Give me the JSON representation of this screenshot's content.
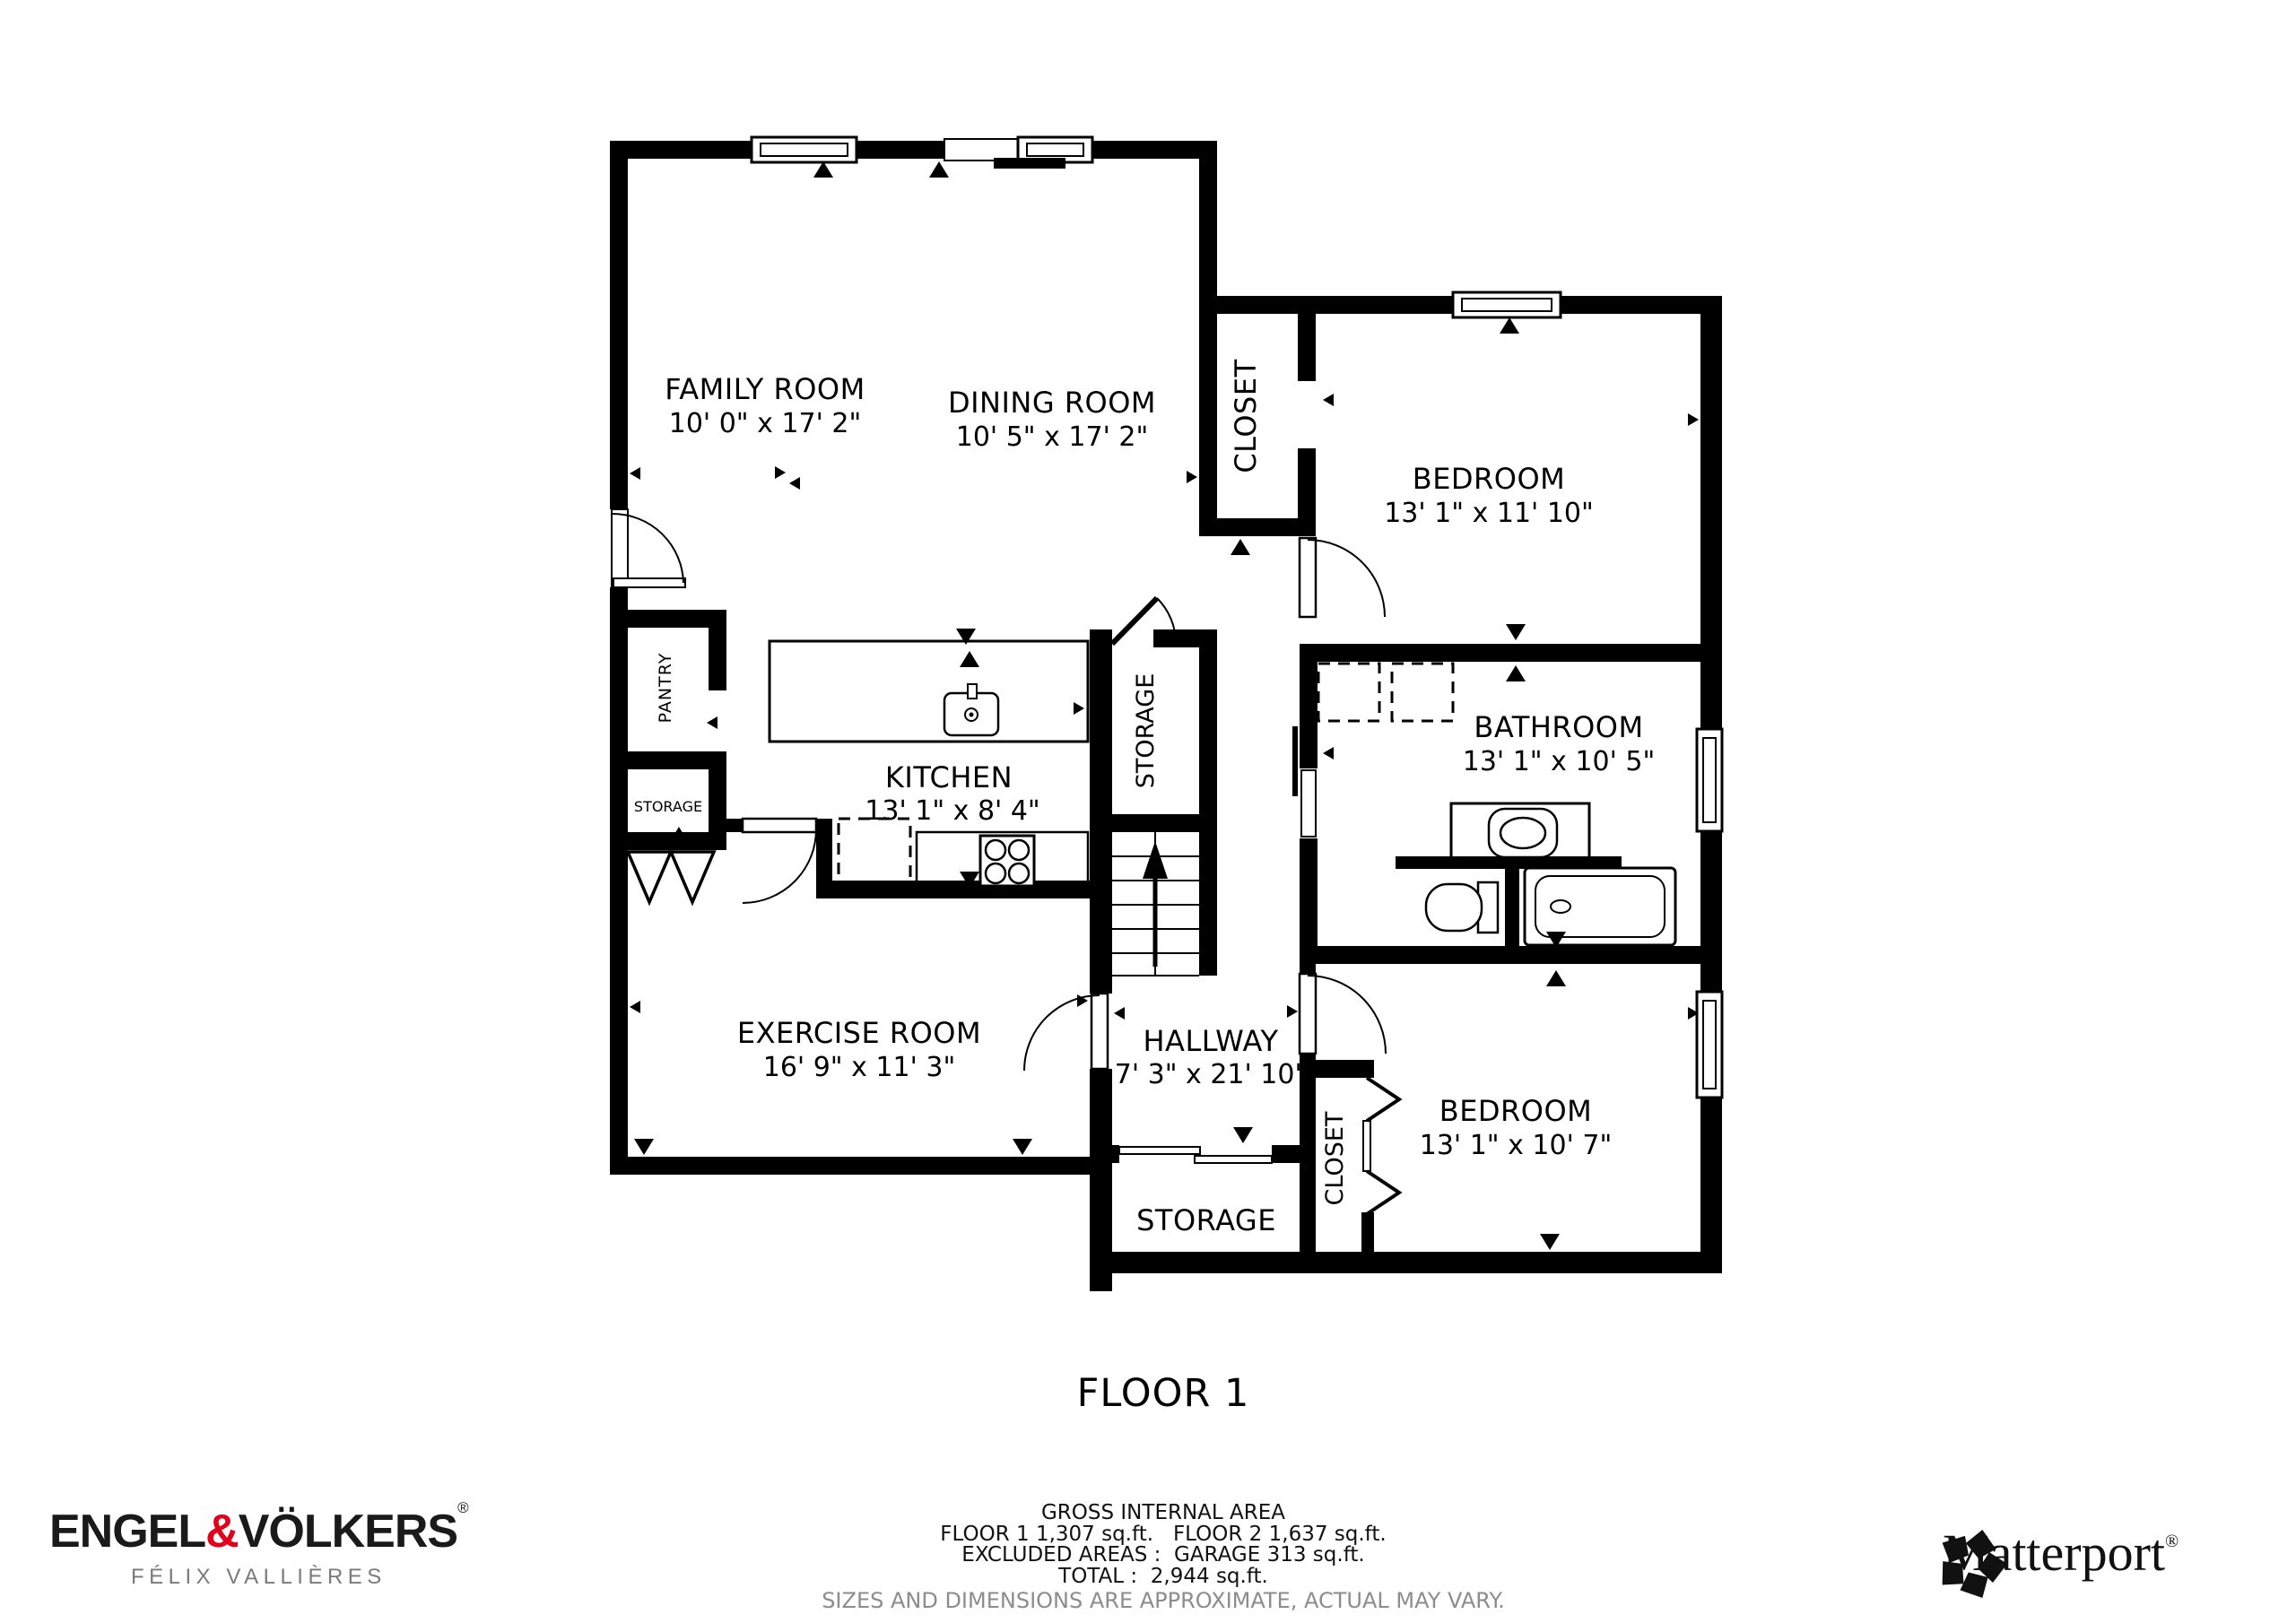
{
  "title": "FLOOR 1",
  "accent_red": "#e2001a",
  "rooms": {
    "family": {
      "name": "FAMILY ROOM",
      "dims": "10' 0\" x 17' 2\""
    },
    "dining": {
      "name": "DINING ROOM",
      "dims": "10' 5\" x 17' 2\""
    },
    "closet_top": {
      "name": "CLOSET"
    },
    "bedroom_top": {
      "name": "BEDROOM",
      "dims": "13' 1\" x 11' 10\""
    },
    "pantry": {
      "name": "PANTRY"
    },
    "storage_left": {
      "name": "STORAGE"
    },
    "kitchen": {
      "name": "KITCHEN",
      "dims": "13' 1\" x 8' 4\""
    },
    "storage_mid": {
      "name": "STORAGE"
    },
    "bathroom": {
      "name": "BATHROOM",
      "dims": "13' 1\" x 10' 5\""
    },
    "exercise": {
      "name": "EXERCISE ROOM",
      "dims": "16' 9\" x 11' 3\""
    },
    "hallway": {
      "name": "HALLWAY",
      "dims": "7' 3\" x 21' 10\""
    },
    "storage_bottom": {
      "name": "STORAGE"
    },
    "closet_bottom": {
      "name": "CLOSET"
    },
    "bedroom_bottom": {
      "name": "BEDROOM",
      "dims": "13' 1\" x 10' 7\""
    }
  },
  "footer": {
    "brand": {
      "left": "ENGEL",
      "amp": "&",
      "right": "VÖLKERS",
      "reg": "®",
      "agent": "FÉLIX VALLIÈRES"
    },
    "area": {
      "title": "GROSS INTERNAL AREA",
      "floors": "FLOOR 1 1,307 sq.ft.   FLOOR 2 1,637 sq.ft.",
      "excluded": "EXCLUDED AREAS :  GARAGE 313 sq.ft.",
      "total": "TOTAL :  2,944 sq.ft.",
      "disclaimer": "SIZES AND DIMENSIONS ARE APPROXIMATE, ACTUAL MAY VARY."
    },
    "matterport": {
      "name": "Matterport",
      "reg": "®"
    }
  }
}
